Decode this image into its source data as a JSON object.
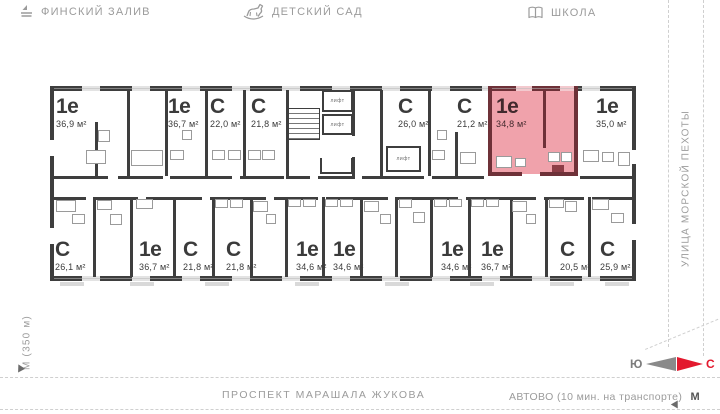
{
  "landmarks": {
    "gulf": {
      "icon": "sailboat-icon",
      "label": "ФИНСКИЙ ЗАЛИВ"
    },
    "kindergarten": {
      "icon": "rocking-horse-icon",
      "label": "ДЕТСКИЙ САД"
    },
    "school": {
      "icon": "book-icon",
      "label": "ШКОЛА"
    }
  },
  "streets": {
    "right_vertical": "УЛИЦА МОРСКОЙ ПЕХОТЫ",
    "bottom": "ПРОСПЕКТ МАРАШАЛА ЖУКОВА",
    "bottom_right": "АВТОВО (10 мин. на транспорте)",
    "bottom_right_metro": "М",
    "left_vertical": "М (350 м)"
  },
  "compass": {
    "south": "Ю",
    "north": "С"
  },
  "colors": {
    "wall": "#3e3e3e",
    "highlight_fill": "#f0a2ab",
    "highlight_wall": "#6e3138",
    "accent_red": "#e3192e",
    "muted_text": "#9b9b9b"
  },
  "floorplan": {
    "lift_label": "лифт",
    "units_top": [
      {
        "name": "1е",
        "area": "36,9 м²",
        "x": 56,
        "highlighted": false
      },
      {
        "name": "1е",
        "area": "36,7 м²",
        "x": 168,
        "highlighted": false
      },
      {
        "name": "С",
        "area": "22,0 м²",
        "x": 210,
        "highlighted": false
      },
      {
        "name": "С",
        "area": "21,8 м²",
        "x": 251,
        "highlighted": false
      },
      {
        "name": "С",
        "area": "26,0 м²",
        "x": 398,
        "highlighted": false
      },
      {
        "name": "С",
        "area": "21,2 м²",
        "x": 457,
        "highlighted": false
      },
      {
        "name": "1е",
        "area": "34,8 м²",
        "x": 496,
        "highlighted": true
      },
      {
        "name": "1е",
        "area": "35,0 м²",
        "x": 596,
        "highlighted": false
      }
    ],
    "units_bottom": [
      {
        "name": "С",
        "area": "26,1 м²",
        "x": 55,
        "highlighted": false
      },
      {
        "name": "1е",
        "area": "36,7 м²",
        "x": 139,
        "highlighted": false
      },
      {
        "name": "С",
        "area": "21,8 м²",
        "x": 183,
        "highlighted": false
      },
      {
        "name": "С",
        "area": "21,8 м²",
        "x": 226,
        "highlighted": false
      },
      {
        "name": "1е",
        "area": "34,6 м²",
        "x": 296,
        "highlighted": false
      },
      {
        "name": "1е",
        "area": "34,6 м²",
        "x": 333,
        "highlighted": false
      },
      {
        "name": "1е",
        "area": "34,6 м²",
        "x": 441,
        "highlighted": false
      },
      {
        "name": "1е",
        "area": "36,7 м²",
        "x": 481,
        "highlighted": false
      },
      {
        "name": "С",
        "area": "20,5 м²",
        "x": 560,
        "highlighted": false
      },
      {
        "name": "С",
        "area": "25,9 м²",
        "x": 600,
        "highlighted": false
      }
    ]
  }
}
